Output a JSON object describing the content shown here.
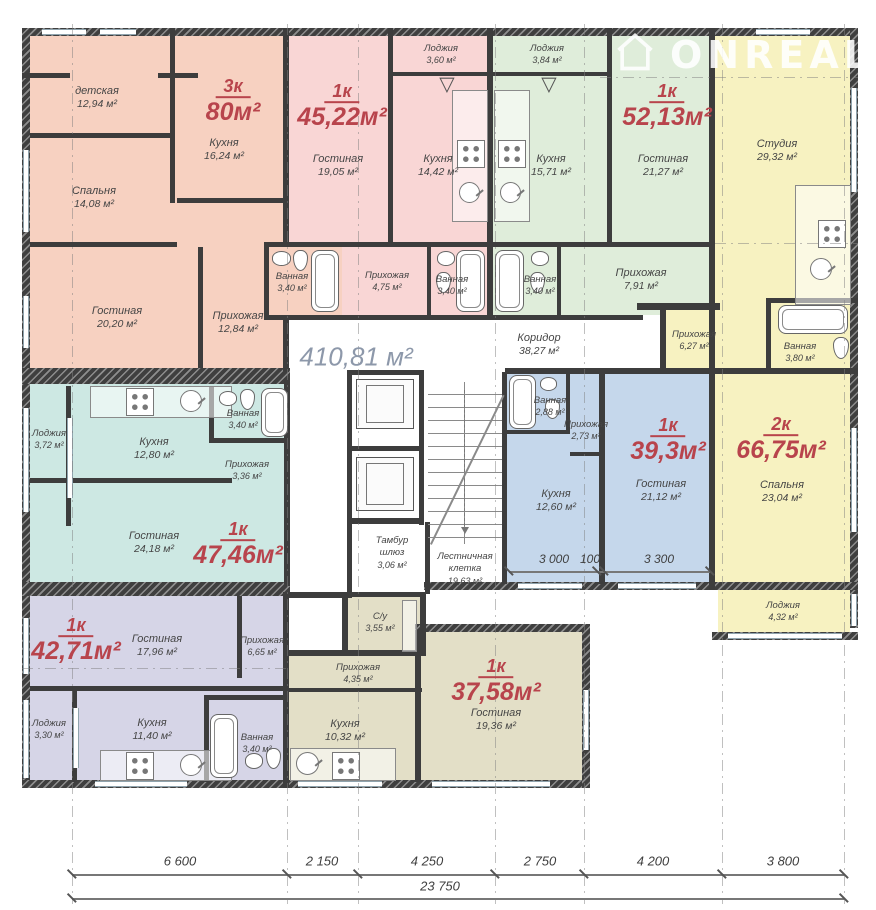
{
  "watermark": {
    "brand": "ONREAL"
  },
  "common": {
    "total_area": "410,81 м²",
    "corridor_name": "Коридор",
    "corridor_area": "38,27 м²",
    "tambur_name": "Тамбур шлюз",
    "tambur_area": "3,06 м²",
    "stairs_name": "Лестничная клетка",
    "stairs_area": "19,63 м²"
  },
  "apartments": [
    {
      "type": "3к",
      "area": "80м²",
      "rooms": [
        {
          "name": "детская",
          "area": "12,94 м²"
        },
        {
          "name": "Кухня",
          "area": "16,24 м²"
        },
        {
          "name": "Спальня",
          "area": "14,08 м²"
        },
        {
          "name": "Гостиная",
          "area": "20,20 м²"
        },
        {
          "name": "Прихожая",
          "area": "12,84 м²"
        },
        {
          "name": "Ванная",
          "area": "3,40 м²"
        }
      ]
    },
    {
      "type": "1к",
      "area": "45,22м²",
      "rooms": [
        {
          "name": "Лоджия",
          "area": "3,60 м²"
        },
        {
          "name": "Гостиная",
          "area": "19,05 м²"
        },
        {
          "name": "Кухня",
          "area": "14,42 м²"
        },
        {
          "name": "Прихожая",
          "area": "4,75 м²"
        },
        {
          "name": "Ванная",
          "area": "3,40 м²"
        }
      ]
    },
    {
      "type": "1к",
      "area": "52,13м²",
      "rooms": [
        {
          "name": "Лоджия",
          "area": "3,84 м²"
        },
        {
          "name": "Кухня",
          "area": "15,71 м²"
        },
        {
          "name": "Гостиная",
          "area": "21,27 м²"
        },
        {
          "name": "Ванная",
          "area": "3,40 м²"
        },
        {
          "name": "Прихожая",
          "area": "7,91 м²"
        }
      ]
    },
    {
      "type": "2к",
      "area": "66,75м²",
      "rooms": [
        {
          "name": "Студия",
          "area": "29,32 м²"
        },
        {
          "name": "Ванная",
          "area": "3,80 м²"
        },
        {
          "name": "Прихожая",
          "area": "6,27 м²"
        },
        {
          "name": "Спальня",
          "area": "23,04 м²"
        },
        {
          "name": "Лоджия",
          "area": "4,32 м²"
        }
      ]
    },
    {
      "type": "1к",
      "area": "47,46м²",
      "rooms": [
        {
          "name": "Лоджия",
          "area": "3,72 м²"
        },
        {
          "name": "Кухня",
          "area": "12,80 м²"
        },
        {
          "name": "Ванная",
          "area": "3,40 м²"
        },
        {
          "name": "Прихожая",
          "area": "3,36 м²"
        },
        {
          "name": "Гостиная",
          "area": "24,18 м²"
        }
      ]
    },
    {
      "type": "1к",
      "area": "39,3м²",
      "rooms": [
        {
          "name": "Ванная",
          "area": "2,88 м²"
        },
        {
          "name": "Прихожая",
          "area": "2,73 м²"
        },
        {
          "name": "Кухня",
          "area": "12,60 м²"
        },
        {
          "name": "Гостиная",
          "area": "21,12 м²"
        }
      ]
    },
    {
      "type": "1к",
      "area": "42,71м²",
      "rooms": [
        {
          "name": "Гостиная",
          "area": "17,96 м²"
        },
        {
          "name": "Прихожая",
          "area": "6,65 м²"
        },
        {
          "name": "Лоджия",
          "area": "3,30 м²"
        },
        {
          "name": "Кухня",
          "area": "11,40 м²"
        },
        {
          "name": "Ванная",
          "area": "3,40 м²"
        }
      ]
    },
    {
      "type": "1к",
      "area": "37,58м²",
      "rooms": [
        {
          "name": "С/у",
          "area": "3,55 м²"
        },
        {
          "name": "Прихожая",
          "area": "4,35 м²"
        },
        {
          "name": "Кухня",
          "area": "10,32 м²"
        },
        {
          "name": "Гостиная",
          "area": "19,36 м²"
        }
      ]
    }
  ],
  "dimensions": {
    "bottom": [
      "6 600",
      "2 150",
      "4 250",
      "2 750",
      "4 200",
      "3 800"
    ],
    "total": "23 750",
    "apartment": [
      "3 000",
      "100",
      "3 300"
    ]
  },
  "colors": {
    "apt_3k_80": "#f7d1c1",
    "apt_1k_4522": "#f9d6d5",
    "apt_1k_5213": "#dfedda",
    "apt_2k_6675": "#f7f2c1",
    "apt_1k_4746": "#cde8e3",
    "apt_1k_393": "#c5d7eb",
    "apt_1k_4271": "#d6d5e7",
    "apt_1k_3758": "#e3dfc7",
    "wall": "#3d3d3d",
    "apartment_label": "#b8444c",
    "room_text": "#454545",
    "total_area_text": "#8d98aa"
  }
}
